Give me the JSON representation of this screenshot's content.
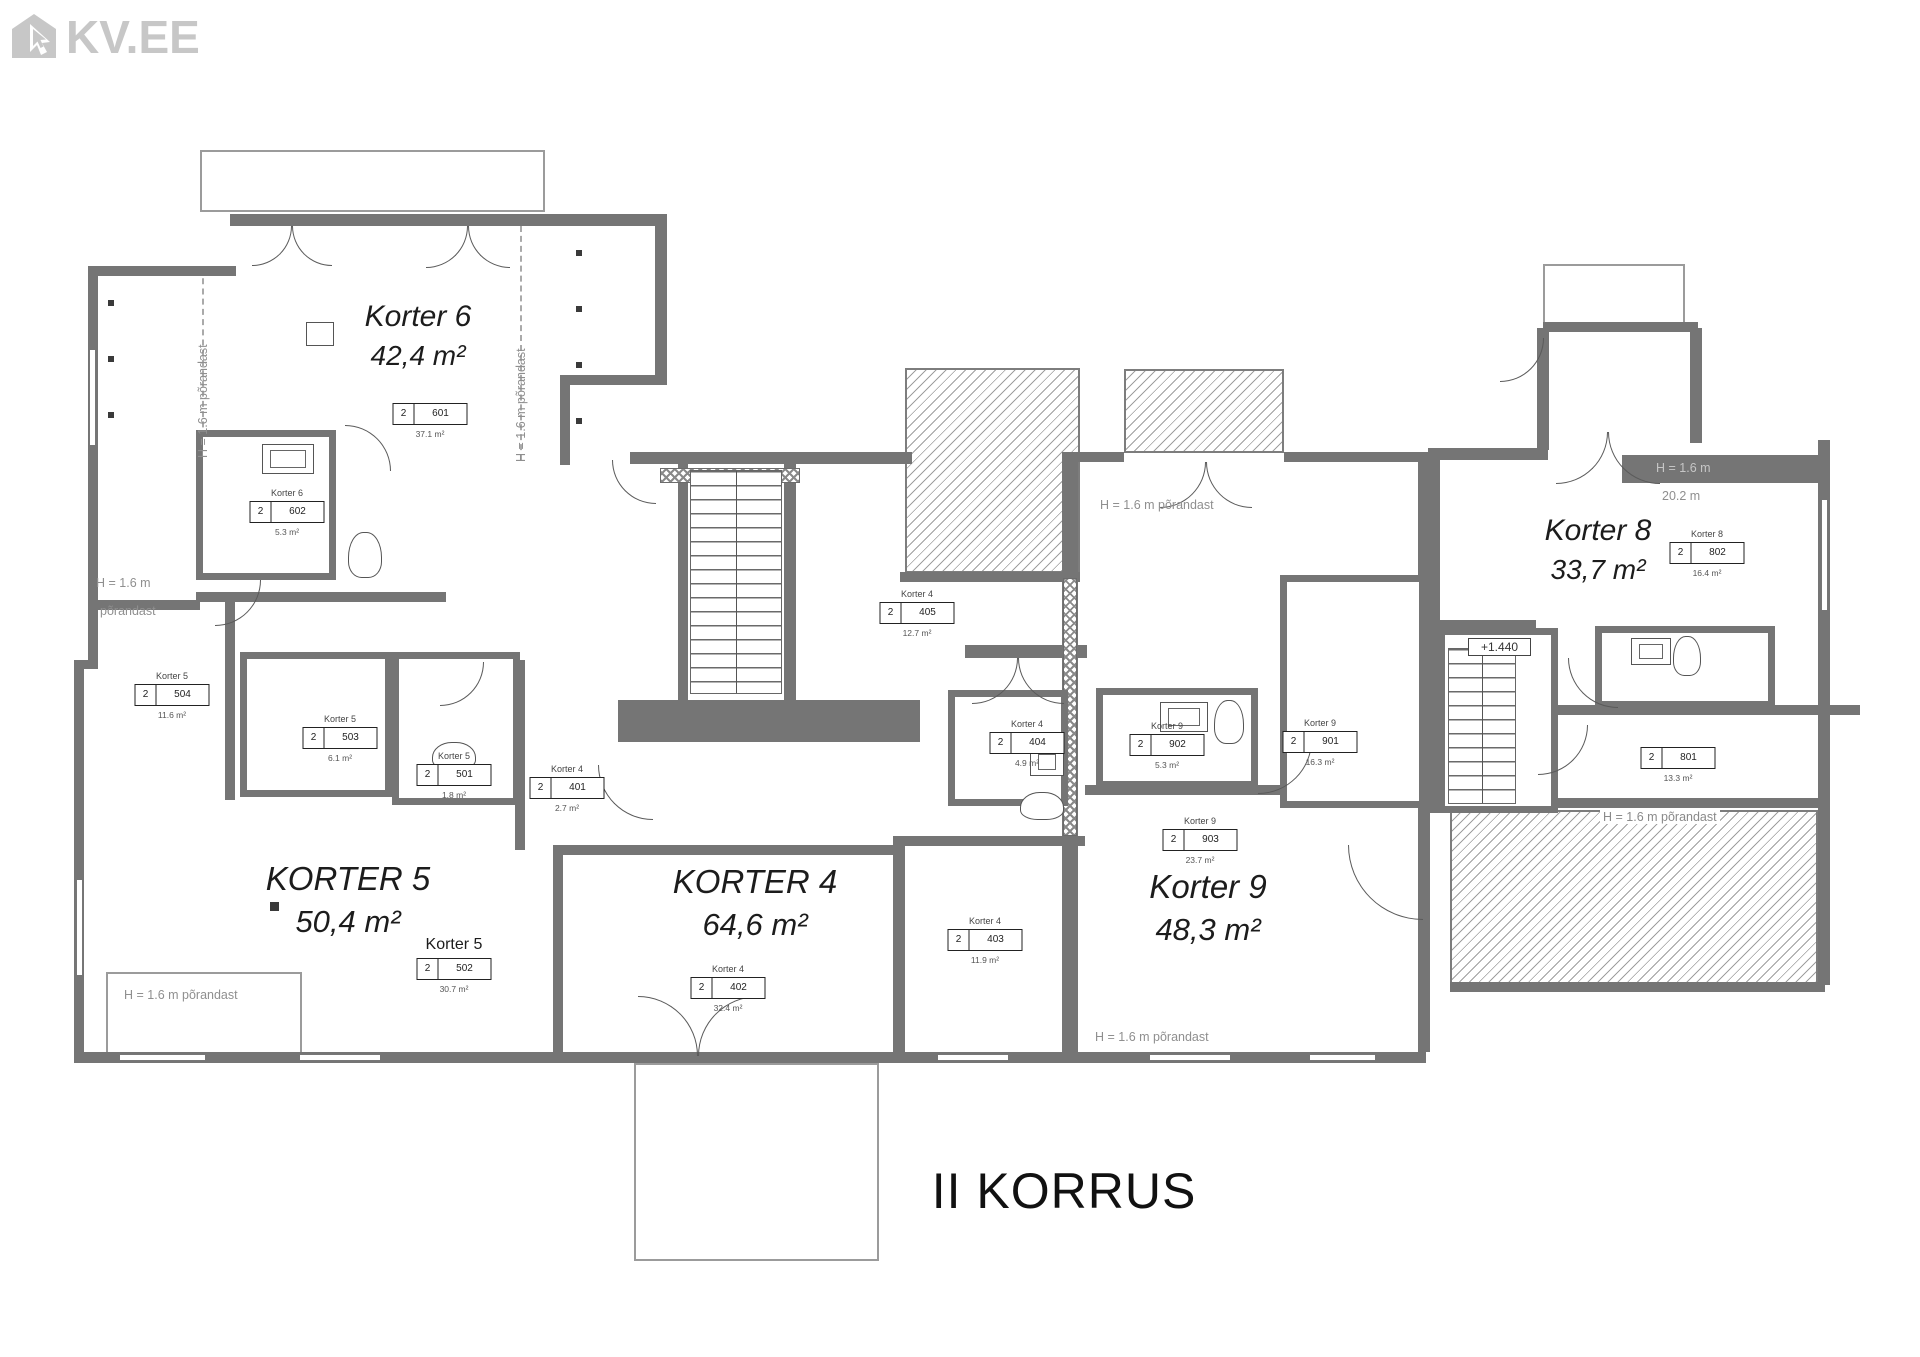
{
  "logo": {
    "text": "KV.EE",
    "color": "#c7c7c7"
  },
  "floor_title": "II KORRUS",
  "colors": {
    "wall": "#757575",
    "logo_gray": "#c7c7c7",
    "annotation_gray": "#8f8f8f",
    "text_dark": "#1c1c1c"
  },
  "apartments": [
    {
      "name": "Korter 6",
      "area": "42,4 m²",
      "x": 418,
      "y": 300,
      "cls": "md"
    },
    {
      "name": "KORTER 5",
      "area": "50,4 m²",
      "x": 348,
      "y": 860,
      "cls": "lg"
    },
    {
      "name": "KORTER 4",
      "area": "64,6 m²",
      "x": 755,
      "y": 863,
      "cls": "lg"
    },
    {
      "name": "Korter 9",
      "area": "48,3 m²",
      "x": 1208,
      "y": 868,
      "cls": "lg"
    },
    {
      "name": "Korter 8",
      "area": "33,7 m²",
      "x": 1598,
      "y": 514,
      "cls": "md"
    }
  ],
  "room_labels": [
    {
      "apartment": "",
      "floor": "2",
      "number": "601",
      "area": "37.1 m²",
      "x": 430,
      "y": 390
    },
    {
      "apartment": "Korter 6",
      "floor": "2",
      "number": "602",
      "area": "5.3 m²",
      "x": 287,
      "y": 488
    },
    {
      "apartment": "Korter 5",
      "floor": "2",
      "number": "504",
      "area": "11.6 m²",
      "x": 172,
      "y": 671
    },
    {
      "apartment": "Korter 5",
      "floor": "2",
      "number": "503",
      "area": "6.1 m²",
      "x": 340,
      "y": 714
    },
    {
      "apartment": "Korter 5",
      "floor": "2",
      "number": "501",
      "area": "1.8 m²",
      "x": 454,
      "y": 751
    },
    {
      "apartment": "Korter 5",
      "floor": "2",
      "number": "502",
      "area": "30.7 m²",
      "x": 454,
      "y": 936,
      "big_name": true
    },
    {
      "apartment": "Korter 4",
      "floor": "2",
      "number": "401",
      "area": "2.7 m²",
      "x": 567,
      "y": 764
    },
    {
      "apartment": "Korter 4",
      "floor": "2",
      "number": "405",
      "area": "12.7 m²",
      "x": 917,
      "y": 589
    },
    {
      "apartment": "Korter 4",
      "floor": "2",
      "number": "404",
      "area": "4.9 m²",
      "x": 1027,
      "y": 719
    },
    {
      "apartment": "Korter 4",
      "floor": "2",
      "number": "403",
      "area": "11.9 m²",
      "x": 985,
      "y": 916
    },
    {
      "apartment": "Korter 4",
      "floor": "2",
      "number": "402",
      "area": "32.4 m²",
      "x": 728,
      "y": 964
    },
    {
      "apartment": "Korter 9",
      "floor": "2",
      "number": "902",
      "area": "5.3 m²",
      "x": 1167,
      "y": 721
    },
    {
      "apartment": "Korter 9",
      "floor": "2",
      "number": "901",
      "area": "16.3 m²",
      "x": 1320,
      "y": 718
    },
    {
      "apartment": "Korter 9",
      "floor": "2",
      "number": "903",
      "area": "23.7 m²",
      "x": 1200,
      "y": 816
    },
    {
      "apartment": "Korter 8",
      "floor": "2",
      "number": "802",
      "area": "16.4 m²",
      "x": 1707,
      "y": 529
    },
    {
      "apartment": "",
      "floor": "2",
      "number": "801",
      "area": "13.3 m²",
      "x": 1678,
      "y": 734
    }
  ],
  "annotations": [
    {
      "text": "H = 1.6 m põrandast",
      "x": 196,
      "y": 458,
      "cls": "vert"
    },
    {
      "text": "H = 1.6 m põrandast",
      "x": 514,
      "y": 462,
      "cls": "vert"
    },
    {
      "text": "H = 1.6 m",
      "x": 96,
      "y": 576
    },
    {
      "text": "põrandast",
      "x": 100,
      "y": 604
    },
    {
      "text": "H = 1.6 m põrandast",
      "x": 124,
      "y": 988
    },
    {
      "text": "H = 1.6 m põrandast",
      "x": 1100,
      "y": 498
    },
    {
      "text": "H = 1.6 m põrandast",
      "x": 1095,
      "y": 1030
    },
    {
      "text": "H = 1.6 m põrandast",
      "x": 1600,
      "y": 810,
      "cls": "bg"
    },
    {
      "text": "H = 1.6 m",
      "x": 1656,
      "y": 461,
      "cls": "onwall"
    },
    {
      "text": "20.2 m",
      "x": 1662,
      "y": 489
    },
    {
      "text": "+1.440",
      "x": 1468,
      "y": 638,
      "cls": "boxed"
    }
  ],
  "geometry": [
    {
      "t": "hatch",
      "x": 905,
      "y": 368,
      "w": 175,
      "h": 205
    },
    {
      "t": "hatch",
      "x": 1124,
      "y": 369,
      "w": 160,
      "h": 84
    },
    {
      "t": "hatch",
      "x": 1450,
      "y": 810,
      "w": 368,
      "h": 174
    },
    {
      "t": "thin",
      "x": 200,
      "y": 150,
      "w": 345,
      "h": 62
    },
    {
      "t": "thin",
      "x": 1543,
      "y": 264,
      "w": 142,
      "h": 60
    },
    {
      "t": "thin",
      "x": 634,
      "y": 1063,
      "w": 245,
      "h": 198
    },
    {
      "t": "thin",
      "x": 106,
      "y": 972,
      "w": 196,
      "h": 88
    },
    {
      "t": "dashv",
      "x": 202,
      "y": 268,
      "h": 190
    },
    {
      "t": "dashv",
      "x": 520,
      "y": 226,
      "h": 234
    },
    {
      "t": "wall",
      "x": 230,
      "y": 214,
      "w": 437,
      "h": 12
    },
    {
      "t": "wall",
      "x": 88,
      "y": 266,
      "w": 148,
      "h": 10
    },
    {
      "t": "wall",
      "x": 88,
      "y": 266,
      "w": 10,
      "h": 402
    },
    {
      "t": "wall",
      "x": 74,
      "y": 660,
      "w": 24,
      "h": 9
    },
    {
      "t": "wall",
      "x": 74,
      "y": 660,
      "w": 10,
      "h": 403
    },
    {
      "t": "wall",
      "x": 74,
      "y": 1052,
      "w": 1352,
      "h": 11
    },
    {
      "t": "wall",
      "x": 655,
      "y": 214,
      "w": 12,
      "h": 166
    },
    {
      "t": "wall",
      "x": 560,
      "y": 375,
      "w": 107,
      "h": 10
    },
    {
      "t": "wall",
      "x": 560,
      "y": 375,
      "w": 10,
      "h": 90
    },
    {
      "t": "wall",
      "x": 196,
      "y": 592,
      "w": 250,
      "h": 10
    },
    {
      "t": "wall",
      "x": 88,
      "y": 600,
      "w": 112,
      "h": 10
    },
    {
      "t": "wall",
      "x": 225,
      "y": 600,
      "w": 10,
      "h": 200
    },
    {
      "t": "wall",
      "x": 630,
      "y": 452,
      "w": 282,
      "h": 12
    },
    {
      "t": "wall",
      "x": 678,
      "y": 455,
      "w": 10,
      "h": 250
    },
    {
      "t": "wall",
      "x": 784,
      "y": 455,
      "w": 12,
      "h": 250
    },
    {
      "t": "block",
      "x": 618,
      "y": 700,
      "w": 302,
      "h": 42
    },
    {
      "t": "wall",
      "x": 900,
      "y": 572,
      "w": 180,
      "h": 10
    },
    {
      "t": "wall",
      "x": 965,
      "y": 645,
      "w": 122,
      "h": 13
    },
    {
      "t": "wall",
      "x": 1062,
      "y": 452,
      "w": 16,
      "h": 600
    },
    {
      "t": "wall",
      "x": 1076,
      "y": 452,
      "w": 48,
      "h": 10
    },
    {
      "t": "wall",
      "x": 1284,
      "y": 452,
      "w": 140,
      "h": 10
    },
    {
      "t": "wall",
      "x": 895,
      "y": 836,
      "w": 190,
      "h": 10
    },
    {
      "t": "wall",
      "x": 893,
      "y": 836,
      "w": 12,
      "h": 216
    },
    {
      "t": "wall",
      "x": 553,
      "y": 845,
      "w": 348,
      "h": 10
    },
    {
      "t": "wall",
      "x": 553,
      "y": 845,
      "w": 10,
      "h": 207
    },
    {
      "t": "wall",
      "x": 515,
      "y": 660,
      "w": 10,
      "h": 190
    },
    {
      "t": "wall",
      "x": 1085,
      "y": 785,
      "w": 215,
      "h": 10
    },
    {
      "t": "wall",
      "x": 1418,
      "y": 452,
      "w": 12,
      "h": 600
    },
    {
      "t": "wall",
      "x": 1543,
      "y": 322,
      "w": 155,
      "h": 10
    },
    {
      "t": "wall",
      "x": 1537,
      "y": 328,
      "w": 12,
      "h": 122
    },
    {
      "t": "wall",
      "x": 1690,
      "y": 328,
      "w": 12,
      "h": 115
    },
    {
      "t": "wall",
      "x": 1428,
      "y": 448,
      "w": 120,
      "h": 12
    },
    {
      "t": "block",
      "x": 1622,
      "y": 455,
      "w": 200,
      "h": 28
    },
    {
      "t": "wall",
      "x": 1818,
      "y": 440,
      "w": 12,
      "h": 545
    },
    {
      "t": "wall",
      "x": 1428,
      "y": 448,
      "w": 12,
      "h": 365
    },
    {
      "t": "wall",
      "x": 1522,
      "y": 620,
      "w": 14,
      "h": 188
    },
    {
      "t": "wall",
      "x": 1558,
      "y": 705,
      "w": 302,
      "h": 10
    },
    {
      "t": "wall",
      "x": 1535,
      "y": 798,
      "w": 290,
      "h": 10
    },
    {
      "t": "wall",
      "x": 1428,
      "y": 620,
      "w": 100,
      "h": 10
    },
    {
      "t": "wall",
      "x": 1450,
      "y": 982,
      "w": 375,
      "h": 10
    },
    {
      "t": "xband",
      "x": 660,
      "y": 468,
      "w": 140,
      "h": 15
    },
    {
      "t": "xbandv",
      "x": 1063,
      "y": 578,
      "w": 14,
      "h": 258
    },
    {
      "t": "room",
      "x": 196,
      "y": 430,
      "w": 140,
      "h": 150
    },
    {
      "t": "room",
      "x": 240,
      "y": 652,
      "w": 152,
      "h": 145
    },
    {
      "t": "room",
      "x": 392,
      "y": 652,
      "w": 128,
      "h": 153
    },
    {
      "t": "room",
      "x": 948,
      "y": 690,
      "w": 120,
      "h": 116
    },
    {
      "t": "room",
      "x": 1096,
      "y": 688,
      "w": 162,
      "h": 100
    },
    {
      "t": "room",
      "x": 1280,
      "y": 575,
      "w": 146,
      "h": 233
    },
    {
      "t": "room",
      "x": 1438,
      "y": 628,
      "w": 120,
      "h": 185
    },
    {
      "t": "room",
      "x": 1595,
      "y": 626,
      "w": 180,
      "h": 82
    },
    {
      "t": "stairs",
      "x": 690,
      "y": 470,
      "w": 92,
      "h": 224
    },
    {
      "t": "stairs",
      "x": 1448,
      "y": 648,
      "w": 68,
      "h": 156
    },
    {
      "t": "winh",
      "x": 120,
      "y": 1054,
      "w": 85,
      "h": 7
    },
    {
      "t": "winh",
      "x": 300,
      "y": 1054,
      "w": 80,
      "h": 7
    },
    {
      "t": "winh",
      "x": 938,
      "y": 1054,
      "w": 70,
      "h": 7
    },
    {
      "t": "winh",
      "x": 1150,
      "y": 1054,
      "w": 80,
      "h": 7
    },
    {
      "t": "winh",
      "x": 1310,
      "y": 1054,
      "w": 65,
      "h": 7
    },
    {
      "t": "winv",
      "x": 1821,
      "y": 500,
      "w": 7,
      "h": 110
    },
    {
      "t": "winv",
      "x": 89,
      "y": 350,
      "w": 7,
      "h": 95
    },
    {
      "t": "winv",
      "x": 76,
      "y": 880,
      "w": 7,
      "h": 95
    },
    {
      "t": "fix",
      "x": 306,
      "y": 322,
      "w": 28,
      "h": 24
    },
    {
      "t": "sink",
      "x": 262,
      "y": 444,
      "w": 52,
      "h": 30
    },
    {
      "t": "sink",
      "x": 1160,
      "y": 702,
      "w": 48,
      "h": 30
    },
    {
      "t": "sink",
      "x": 1631,
      "y": 638,
      "w": 40,
      "h": 27
    },
    {
      "t": "sink",
      "x": 1030,
      "y": 748,
      "w": 34,
      "h": 28
    },
    {
      "t": "wc",
      "x": 348,
      "y": 532,
      "w": 34,
      "h": 46
    },
    {
      "t": "wc",
      "x": 1214,
      "y": 700,
      "w": 30,
      "h": 44
    },
    {
      "t": "wc",
      "x": 1673,
      "y": 636,
      "w": 28,
      "h": 40
    },
    {
      "t": "wc",
      "x": 1020,
      "y": 792,
      "w": 44,
      "h": 28
    },
    {
      "t": "wc",
      "x": 432,
      "y": 742,
      "w": 44,
      "h": 28
    },
    {
      "t": "dot",
      "x": 108,
      "y": 300,
      "w": 6,
      "h": 6
    },
    {
      "t": "dot",
      "x": 108,
      "y": 356,
      "w": 6,
      "h": 6
    },
    {
      "t": "dot",
      "x": 108,
      "y": 412,
      "w": 6,
      "h": 6
    },
    {
      "t": "dot",
      "x": 576,
      "y": 250,
      "w": 6,
      "h": 6
    },
    {
      "t": "dot",
      "x": 576,
      "y": 306,
      "w": 6,
      "h": 6
    },
    {
      "t": "dot",
      "x": 576,
      "y": 362,
      "w": 6,
      "h": 6
    },
    {
      "t": "dot",
      "x": 576,
      "y": 418,
      "w": 6,
      "h": 6
    },
    {
      "t": "dot",
      "x": 270,
      "y": 902,
      "w": 9,
      "h": 9
    },
    {
      "t": "arc",
      "v": "br",
      "x": 252,
      "y": 226,
      "w": 40
    },
    {
      "t": "arc",
      "v": "bl",
      "x": 292,
      "y": 226,
      "w": 40
    },
    {
      "t": "arc",
      "v": "br",
      "x": 426,
      "y": 226,
      "w": 42
    },
    {
      "t": "arc",
      "v": "bl",
      "x": 468,
      "y": 226,
      "w": 42
    },
    {
      "t": "arc",
      "v": "br",
      "x": 215,
      "y": 580,
      "w": 46
    },
    {
      "t": "arc",
      "v": "tr",
      "x": 345,
      "y": 425,
      "w": 46
    },
    {
      "t": "arc",
      "v": "bl",
      "x": 612,
      "y": 460,
      "w": 44
    },
    {
      "t": "arc",
      "v": "br",
      "x": 440,
      "y": 662,
      "w": 44
    },
    {
      "t": "arc",
      "v": "bl",
      "x": 598,
      "y": 765,
      "w": 55
    },
    {
      "t": "arc",
      "v": "tr",
      "x": 638,
      "y": 996,
      "w": 60
    },
    {
      "t": "arc",
      "v": "tl",
      "x": 698,
      "y": 996,
      "w": 60
    },
    {
      "t": "arc",
      "v": "br",
      "x": 972,
      "y": 658,
      "w": 46
    },
    {
      "t": "arc",
      "v": "bl",
      "x": 1018,
      "y": 658,
      "w": 46
    },
    {
      "t": "arc",
      "v": "br",
      "x": 1160,
      "y": 462,
      "w": 46
    },
    {
      "t": "arc",
      "v": "bl",
      "x": 1206,
      "y": 462,
      "w": 46
    },
    {
      "t": "arc",
      "v": "br",
      "x": 1258,
      "y": 740,
      "w": 54
    },
    {
      "t": "arc",
      "v": "bl",
      "x": 1348,
      "y": 845,
      "w": 75
    },
    {
      "t": "arc",
      "v": "br",
      "x": 1556,
      "y": 432,
      "w": 52
    },
    {
      "t": "arc",
      "v": "bl",
      "x": 1608,
      "y": 432,
      "w": 52
    },
    {
      "t": "arc",
      "v": "bl",
      "x": 1568,
      "y": 658,
      "w": 50
    },
    {
      "t": "arc",
      "v": "br",
      "x": 1538,
      "y": 725,
      "w": 50
    },
    {
      "t": "arc",
      "v": "br",
      "x": 1500,
      "y": 338,
      "w": 44
    }
  ]
}
